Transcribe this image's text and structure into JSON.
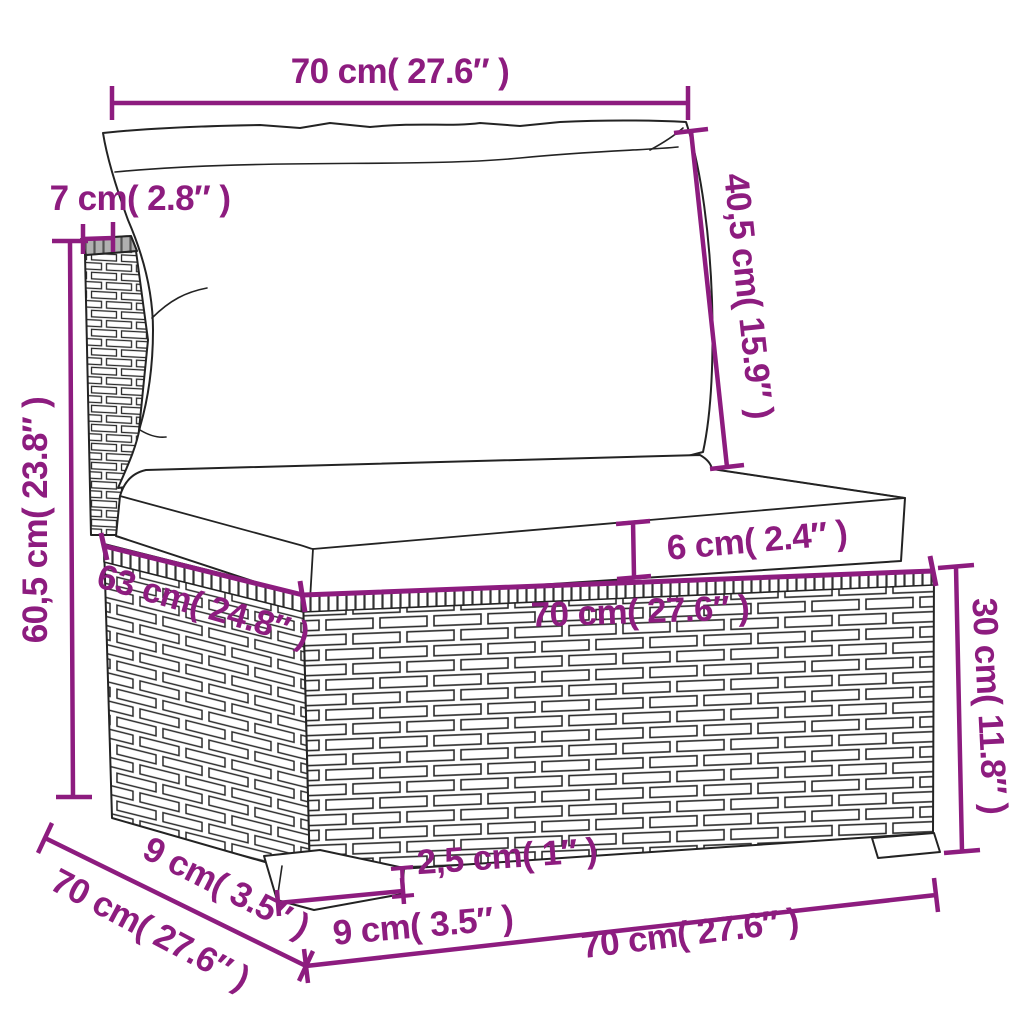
{
  "diagram": {
    "accent_color": "#8d1c7f",
    "outline_color": "#232323",
    "dimensions": {
      "back_width": {
        "label": "70 cm( 27.6″ )",
        "cm": 70,
        "inches": 27.6
      },
      "back_thickness": {
        "label": "7 cm( 2.8″ )",
        "cm": 7,
        "inches": 2.8
      },
      "back_height": {
        "label": "40,5 cm( 15.9″ )",
        "cm": 40.5,
        "inches": 15.9
      },
      "total_height": {
        "label": "60,5 cm( 23.8″ )",
        "cm": 60.5,
        "inches": 23.8
      },
      "cushion_thickness": {
        "label": "6 cm( 2.4″ )",
        "cm": 6,
        "inches": 2.4
      },
      "seat_depth": {
        "label": "63 cm( 24.8″ )",
        "cm": 63,
        "inches": 24.8
      },
      "seat_width": {
        "label": "70 cm( 27.6″ )",
        "cm": 70,
        "inches": 27.6
      },
      "base_height": {
        "label": "30 cm( 11.8″ )",
        "cm": 30,
        "inches": 11.8
      },
      "leg_height": {
        "label": "2,5 cm( 1″ )",
        "cm": 2.5,
        "inches": 1
      },
      "leg_width": {
        "label": "9 cm( 3.5″ )",
        "cm": 9,
        "inches": 3.5
      },
      "leg_depth": {
        "label": "9 cm( 3.5″ )",
        "cm": 9,
        "inches": 3.5
      },
      "base_depth": {
        "label": "70 cm( 27.6″ )",
        "cm": 70,
        "inches": 27.6
      },
      "base_width": {
        "label": "70 cm( 27.6″ )",
        "cm": 70,
        "inches": 27.6
      }
    }
  }
}
